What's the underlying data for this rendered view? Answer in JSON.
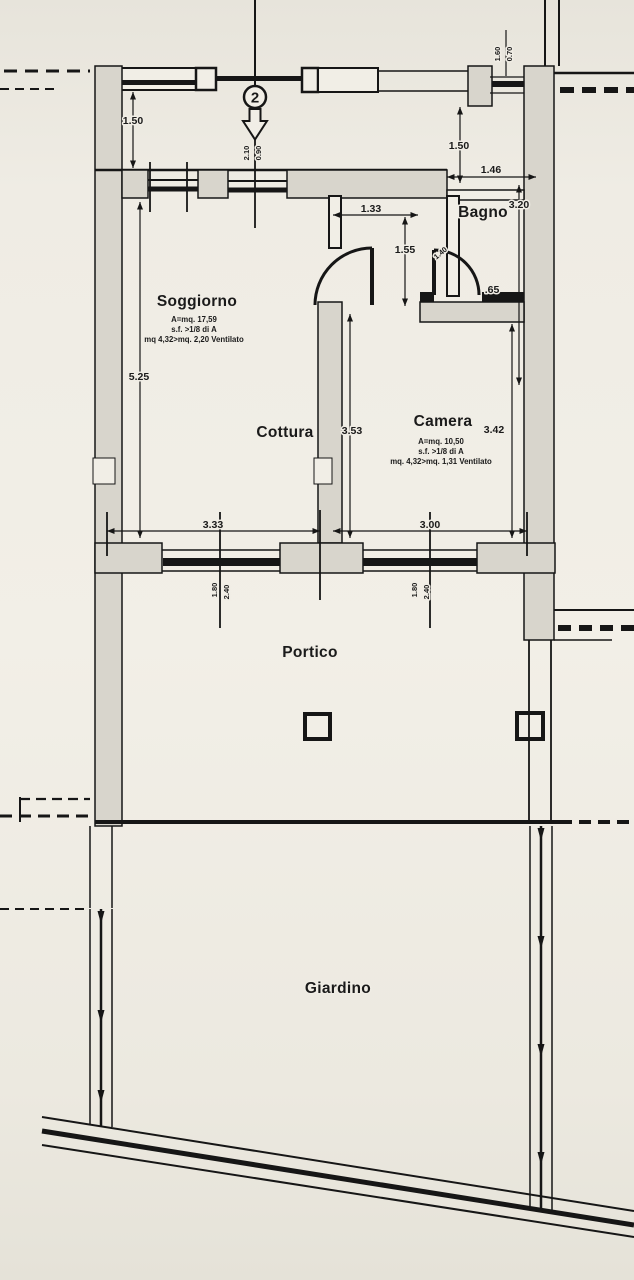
{
  "plan": {
    "unit_number": "2",
    "rooms": {
      "soggiorno": {
        "name": "Soggiorno",
        "area": "A=mq. 17,59",
        "ratio": "s.f. >1/8 di A",
        "vent": "mq 4,32>mq. 2,20 Ventilato"
      },
      "cottura": {
        "name": "Cottura"
      },
      "camera": {
        "name": "Camera",
        "area": "A=mq. 10,50",
        "ratio": "s.f. >1/8 di A",
        "vent": "mq. 4,32>mq. 1,31 Ventilato"
      },
      "bagno": {
        "name": "Bagno"
      },
      "portico": {
        "name": "Portico"
      },
      "giardino": {
        "name": "Giardino"
      }
    },
    "dimensions": {
      "walkway_depth": "1.50",
      "entry_door_height": "2.10",
      "entry_door_width": "0.90",
      "bath_window_height": "1.60",
      "bath_window_width": "0.70",
      "bagno_entry_offset": "1.50",
      "bagno_width": "1.46",
      "bagno_camera_depth": "3.20",
      "hall_width": "1.33",
      "hall_depth": "1.55",
      "hall_door_width": "1.40",
      "bagno_wall_segment": ".65",
      "soggiorno_depth": "5.25",
      "cottura_depth": "3.53",
      "camera_depth": "3.42",
      "soggiorno_window_span": "3.33",
      "camera_window_span": "3.00",
      "french_window_width": "1.80",
      "french_window_height": "2.40"
    }
  }
}
